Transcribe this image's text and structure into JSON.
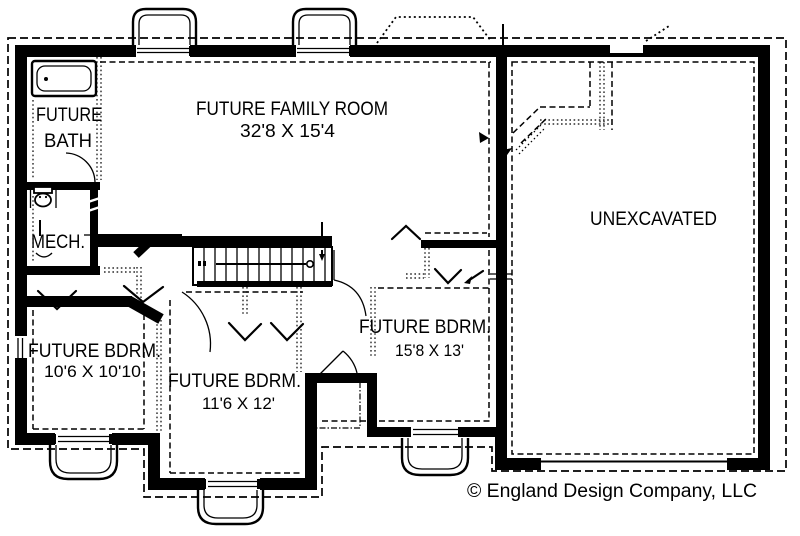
{
  "colors": {
    "ink": "#000000",
    "paper": "#ffffff"
  },
  "rooms": {
    "bath": {
      "line1": "FUTURE",
      "line2": "BATH"
    },
    "mech": {
      "name": "MECH."
    },
    "family_room": {
      "name": "FUTURE FAMILY ROOM",
      "dims": "32'8 X 15'4"
    },
    "unexcavated": {
      "name": "UNEXCAVATED"
    },
    "bdrm_left": {
      "name": "FUTURE BDRM.",
      "dims": "10'6 X 10'10"
    },
    "bdrm_center": {
      "name": "FUTURE BDRM.",
      "dims": "11'6 X 12'"
    },
    "bdrm_right": {
      "name": "FUTURE BDRM.",
      "dims": "15'8 X 13'"
    }
  },
  "footer": {
    "copyright": "© England Design Company, LLC"
  }
}
